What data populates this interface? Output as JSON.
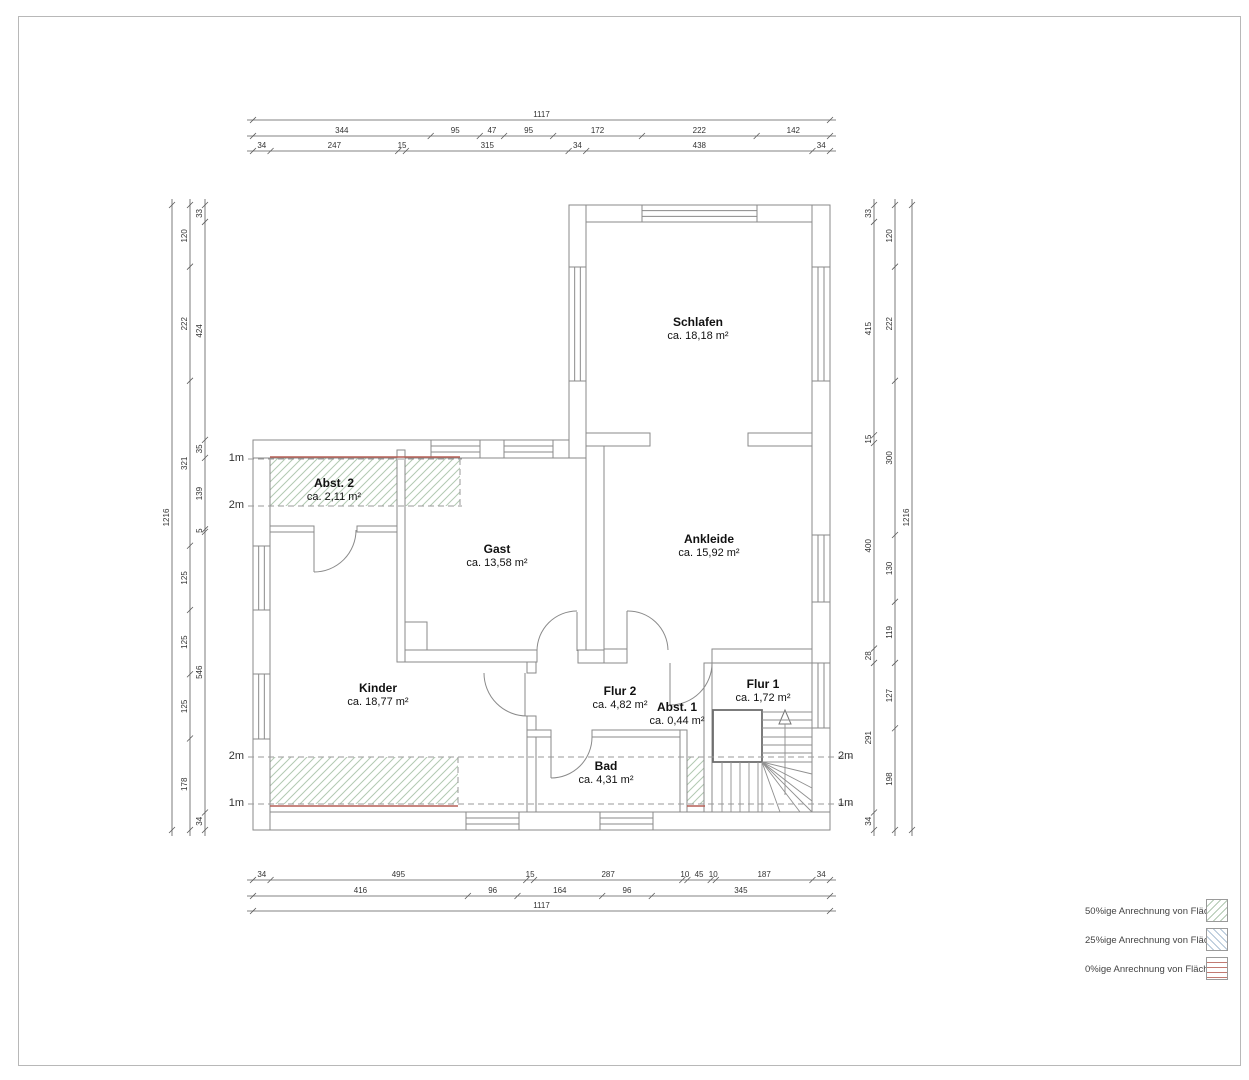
{
  "drawing": {
    "rooms": [
      {
        "id": "schlafen",
        "name": "Schlafen",
        "area": "ca. 18,18 m²"
      },
      {
        "id": "gast",
        "name": "Gast",
        "area": "ca. 13,58 m²"
      },
      {
        "id": "ankleide",
        "name": "Ankleide",
        "area": "ca. 15,92 m²"
      },
      {
        "id": "abst2",
        "name": "Abst. 2",
        "area": "ca. 2,11 m²"
      },
      {
        "id": "kinder",
        "name": "Kinder",
        "area": "ca. 18,77 m²"
      },
      {
        "id": "flur2",
        "name": "Flur 2",
        "area": "ca. 4,82 m²"
      },
      {
        "id": "flur1",
        "name": "Flur 1",
        "area": "ca. 1,72 m²"
      },
      {
        "id": "abst1",
        "name": "Abst. 1",
        "area": "ca. 0,44 m²"
      },
      {
        "id": "bad",
        "name": "Bad",
        "area": "ca. 4,31 m²"
      }
    ],
    "dimensions": {
      "top": {
        "total": [
          "1117"
        ],
        "middle": [
          "344",
          "95",
          "47",
          "95",
          "172",
          "222",
          "142"
        ],
        "inner": [
          "34",
          "247",
          "15",
          "315",
          "34",
          "438",
          "34"
        ]
      },
      "bottom": {
        "inner": [
          "34",
          "495",
          "15",
          "287",
          "10",
          "45",
          "10",
          "187",
          "34"
        ],
        "middle": [
          "416",
          "96",
          "164",
          "96",
          "345"
        ],
        "total": [
          "1117"
        ]
      },
      "left": {
        "total": [
          "1216"
        ],
        "middle": [
          "120",
          "222",
          "321",
          "125",
          "125",
          "125",
          "178"
        ],
        "inner": [
          "33",
          "424",
          "35",
          "139",
          "5",
          "546",
          "34"
        ]
      },
      "right": {
        "inner": [
          "33",
          "415",
          "15",
          "400",
          "28",
          "291",
          "34"
        ],
        "middle": [
          "120",
          "222",
          "300",
          "130",
          "119",
          "127",
          "198"
        ],
        "total": [
          "1216"
        ]
      }
    },
    "height_markers": [
      {
        "id": "upper-left-1m",
        "label": "1m"
      },
      {
        "id": "upper-left-2m",
        "label": "2m"
      },
      {
        "id": "lower-left-2m",
        "label": "2m"
      },
      {
        "id": "lower-left-1m",
        "label": "1m"
      },
      {
        "id": "lower-right-2m",
        "label": "2m"
      },
      {
        "id": "lower-right-1m",
        "label": "1m"
      }
    ],
    "legend": [
      {
        "id": "hatch-50",
        "label": "50%ige Anrechnung von Flächen"
      },
      {
        "id": "hatch-25",
        "label": "25%ige Anrechnung von Flächen"
      },
      {
        "id": "hatch-0",
        "label": "0%ige Anrechnung von Flächen"
      }
    ]
  }
}
